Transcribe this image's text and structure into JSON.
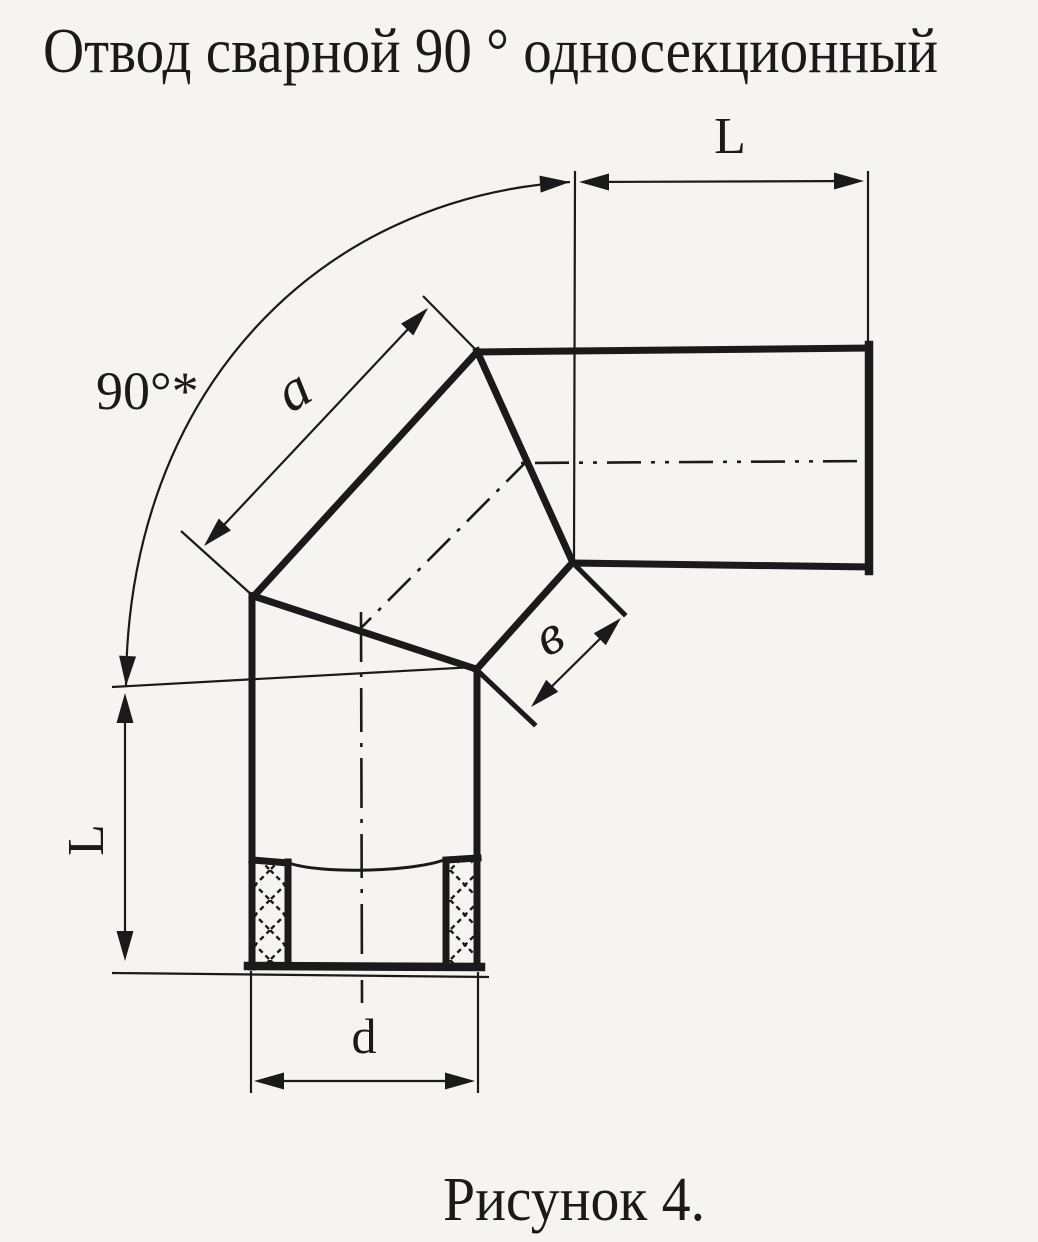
{
  "title": "Отвод сварной 90 ° односекционный",
  "caption": "Рисунок 4.",
  "dimensions": {
    "pipe_length_top": "L",
    "pipe_length_left": "L",
    "bend_angle": "90°*",
    "outer_section_length": "a",
    "inner_section_length": "в",
    "bore_diameter": "d"
  },
  "colors": {
    "paper": "#f5f4f0",
    "ink": "#1a1a1a"
  }
}
